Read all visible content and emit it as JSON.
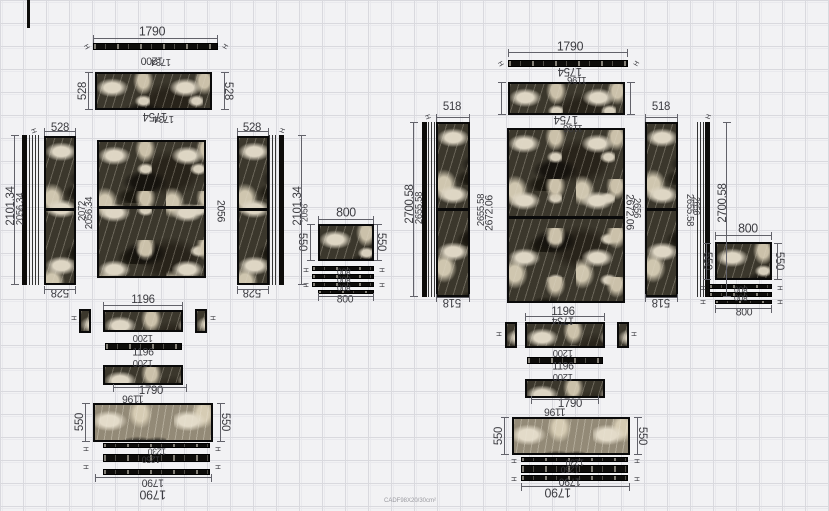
{
  "meta": {
    "watermark": "CADF98X20/30cm²"
  },
  "colors": {
    "canvas_bg": "#f2f2f4",
    "grid_line": "#d9d9de",
    "panel_frame": "#0a0a0a",
    "stone_dark": "#3b372c",
    "stone_vein": "#ded6c4",
    "dim_text": "#3c3c41",
    "dim_line": "#62626a"
  },
  "panels": [
    {
      "n": "corner-line",
      "k": "vs",
      "x": 27,
      "y": 0,
      "w": 3,
      "h": 28
    },
    {
      "n": "left-top-strip",
      "k": "hs",
      "x": 93,
      "y": 43,
      "w": 125,
      "h": 7
    },
    {
      "n": "left-top-panel",
      "k": "m",
      "x": 95,
      "y": 72,
      "w": 117,
      "h": 38
    },
    {
      "n": "left-edge-bar-left",
      "k": "vs",
      "x": 22,
      "y": 135,
      "w": 5,
      "h": 150
    },
    {
      "n": "left-edge-lines-left",
      "k": "ve",
      "x": 29,
      "y": 135,
      "w": 11,
      "h": 150
    },
    {
      "n": "left-side-panel-left",
      "k": "ms",
      "sp": 48,
      "x": 44,
      "y": 136,
      "w": 32,
      "h": 149
    },
    {
      "n": "left-center-panel",
      "k": "ms",
      "sp": 48,
      "x": 97,
      "y": 140,
      "w": 109,
      "h": 138
    },
    {
      "n": "left-side-panel-right",
      "k": "ms",
      "sp": 48,
      "x": 237,
      "y": 136,
      "w": 32,
      "h": 149
    },
    {
      "n": "left-edge-lines-right",
      "k": "ve",
      "x": 269,
      "y": 135,
      "w": 9,
      "h": 150
    },
    {
      "n": "left-edge-bar-right",
      "k": "vs",
      "x": 279,
      "y": 135,
      "w": 5,
      "h": 150
    },
    {
      "n": "left-800-panel",
      "k": "m",
      "x": 318,
      "y": 224,
      "w": 56,
      "h": 37
    },
    {
      "n": "left-800-strip-1",
      "k": "hs",
      "x": 312,
      "y": 266,
      "w": 62,
      "h": 5
    },
    {
      "n": "left-800-strip-2",
      "k": "hs",
      "x": 312,
      "y": 274,
      "w": 62,
      "h": 5
    },
    {
      "n": "left-800-strip-3",
      "k": "hs",
      "x": 312,
      "y": 282,
      "w": 62,
      "h": 5
    },
    {
      "n": "left-800-strip-4",
      "k": "hs",
      "x": 318,
      "y": 290,
      "w": 56,
      "h": 4
    },
    {
      "n": "left-bottom-square-left",
      "k": "sq",
      "x": 79,
      "y": 309,
      "w": 12,
      "h": 24
    },
    {
      "n": "left-bottom-row-1",
      "k": "m",
      "x": 103,
      "y": 310,
      "w": 80,
      "h": 22
    },
    {
      "n": "left-bottom-square-right",
      "k": "sq",
      "x": 195,
      "y": 309,
      "w": 12,
      "h": 24
    },
    {
      "n": "left-bottom-thin-strip",
      "k": "hs",
      "x": 105,
      "y": 343,
      "w": 77,
      "h": 7
    },
    {
      "n": "left-bottom-row-2",
      "k": "m",
      "x": 103,
      "y": 365,
      "w": 80,
      "h": 20
    },
    {
      "n": "left-bottom-panel",
      "k": "m2",
      "x": 93,
      "y": 403,
      "w": 120,
      "h": 39
    },
    {
      "n": "left-bottom-strip-1",
      "k": "hs",
      "x": 103,
      "y": 443,
      "w": 107,
      "h": 5
    },
    {
      "n": "left-bottom-strip-2",
      "k": "hs",
      "x": 103,
      "y": 454,
      "w": 107,
      "h": 8
    },
    {
      "n": "left-bottom-strip-3",
      "k": "hs",
      "x": 103,
      "y": 469,
      "w": 107,
      "h": 6
    },
    {
      "n": "right-top-strip",
      "k": "hs",
      "x": 508,
      "y": 60,
      "w": 120,
      "h": 7
    },
    {
      "n": "right-top-panel",
      "k": "m",
      "x": 508,
      "y": 82,
      "w": 117,
      "h": 33
    },
    {
      "n": "right-edge-bar-left",
      "k": "vs",
      "x": 422,
      "y": 122,
      "w": 5,
      "h": 175
    },
    {
      "n": "right-edge-lines-left",
      "k": "ve",
      "x": 428,
      "y": 122,
      "w": 7,
      "h": 175
    },
    {
      "n": "right-side-panel-left",
      "k": "ms",
      "sp": 49,
      "x": 436,
      "y": 122,
      "w": 34,
      "h": 175
    },
    {
      "n": "right-center-panel",
      "k": "ms",
      "sp": 50,
      "x": 507,
      "y": 128,
      "w": 118,
      "h": 175
    },
    {
      "n": "right-side-panel-right",
      "k": "ms",
      "sp": 49,
      "x": 645,
      "y": 122,
      "w": 33,
      "h": 175
    },
    {
      "n": "right-edge-lines-right",
      "k": "ve",
      "x": 697,
      "y": 122,
      "w": 7,
      "h": 175
    },
    {
      "n": "right-edge-bar-right",
      "k": "vs",
      "x": 705,
      "y": 122,
      "w": 5,
      "h": 175
    },
    {
      "n": "right-800-panel",
      "k": "m",
      "x": 715,
      "y": 242,
      "w": 57,
      "h": 38
    },
    {
      "n": "right-800-strip-1",
      "k": "hs",
      "x": 709,
      "y": 284,
      "w": 63,
      "h": 5
    },
    {
      "n": "right-800-strip-2",
      "k": "hs",
      "x": 709,
      "y": 292,
      "w": 63,
      "h": 5
    },
    {
      "n": "right-800-strip-3",
      "k": "hs",
      "x": 715,
      "y": 300,
      "w": 57,
      "h": 4
    },
    {
      "n": "right-bottom-square-left",
      "k": "sq",
      "x": 505,
      "y": 322,
      "w": 12,
      "h": 26
    },
    {
      "n": "right-bottom-row-1",
      "k": "m",
      "x": 525,
      "y": 322,
      "w": 80,
      "h": 26
    },
    {
      "n": "right-bottom-square-right",
      "k": "sq",
      "x": 617,
      "y": 322,
      "w": 12,
      "h": 26
    },
    {
      "n": "right-bottom-thin-strip",
      "k": "hs",
      "x": 527,
      "y": 357,
      "w": 76,
      "h": 7
    },
    {
      "n": "right-bottom-row-2",
      "k": "m",
      "x": 525,
      "y": 379,
      "w": 80,
      "h": 19
    },
    {
      "n": "right-bottom-panel",
      "k": "m2",
      "x": 512,
      "y": 417,
      "w": 118,
      "h": 38
    },
    {
      "n": "right-bottom-strip-1",
      "k": "hs",
      "x": 521,
      "y": 457,
      "w": 107,
      "h": 5
    },
    {
      "n": "right-bottom-strip-2",
      "k": "hs",
      "x": 521,
      "y": 465,
      "w": 107,
      "h": 8
    },
    {
      "n": "right-bottom-strip-3",
      "k": "hs",
      "x": 521,
      "y": 475,
      "w": 107,
      "h": 6
    }
  ],
  "labels": [
    {
      "t": "1790",
      "x": 152,
      "y": 31,
      "s": 13
    },
    {
      "t": "1200",
      "x": 152,
      "y": 60,
      "r": 180,
      "s": 11
    },
    {
      "t": "1734",
      "x": 161,
      "y": 61,
      "r": 180,
      "s": 10
    },
    {
      "t": "528",
      "x": 82,
      "y": 91,
      "r": -90,
      "s": 12
    },
    {
      "t": "528",
      "x": 229,
      "y": 91,
      "r": 90,
      "s": 12
    },
    {
      "t": "1754",
      "x": 155,
      "y": 117,
      "r": 180,
      "s": 12
    },
    {
      "t": "1734",
      "x": 164,
      "y": 118,
      "r": 180,
      "s": 10
    },
    {
      "t": "528",
      "x": 60,
      "y": 127,
      "s": 12
    },
    {
      "t": "528",
      "x": 252,
      "y": 127,
      "s": 12
    },
    {
      "t": "2101.34",
      "x": 10,
      "y": 206,
      "r": -90,
      "s": 12
    },
    {
      "t": "2056.34",
      "x": 21,
      "y": 209,
      "r": -90,
      "s": 10
    },
    {
      "t": "2072",
      "x": 83,
      "y": 211,
      "r": -90,
      "s": 10
    },
    {
      "t": "2056.34",
      "x": 90,
      "y": 213,
      "r": -90,
      "s": 10
    },
    {
      "t": "2056",
      "x": 220,
      "y": 211,
      "r": 90,
      "s": 11
    },
    {
      "t": "528",
      "x": 60,
      "y": 293,
      "r": 180,
      "s": 12
    },
    {
      "t": "528",
      "x": 252,
      "y": 293,
      "r": 180,
      "s": 12
    },
    {
      "t": "2101.34",
      "x": 297,
      "y": 206,
      "r": -90,
      "s": 12
    },
    {
      "t": "2056",
      "x": 305,
      "y": 213,
      "r": -90,
      "s": 9
    },
    {
      "t": "550",
      "x": 303,
      "y": 242,
      "r": 90,
      "s": 12
    },
    {
      "t": "800",
      "x": 346,
      "y": 212,
      "s": 13
    },
    {
      "t": "550",
      "x": 382,
      "y": 242,
      "r": 90,
      "s": 12
    },
    {
      "t": "800",
      "x": 344,
      "y": 271,
      "r": 180,
      "s": 9
    },
    {
      "t": "800",
      "x": 344,
      "y": 279,
      "r": 180,
      "s": 9
    },
    {
      "t": "800",
      "x": 344,
      "y": 287,
      "r": 180,
      "s": 9
    },
    {
      "t": "800",
      "x": 345,
      "y": 300,
      "s": 11
    },
    {
      "t": "1196",
      "x": 143,
      "y": 299,
      "s": 12
    },
    {
      "t": "1200",
      "x": 143,
      "y": 337,
      "r": 180,
      "s": 10
    },
    {
      "t": "1196",
      "x": 143,
      "y": 353,
      "s": 11
    },
    {
      "t": "1200",
      "x": 143,
      "y": 362,
      "r": 180,
      "s": 10
    },
    {
      "t": "1790",
      "x": 151,
      "y": 390,
      "s": 12
    },
    {
      "t": "1196",
      "x": 133,
      "y": 398,
      "r": 180,
      "s": 11
    },
    {
      "t": "550",
      "x": 79,
      "y": 422,
      "r": -90,
      "s": 12
    },
    {
      "t": "550",
      "x": 226,
      "y": 422,
      "r": 90,
      "s": 12
    },
    {
      "t": "1230",
      "x": 157,
      "y": 451,
      "r": 180,
      "s": 9
    },
    {
      "t": "1250",
      "x": 151,
      "y": 459,
      "r": 180,
      "s": 9
    },
    {
      "t": "1790",
      "x": 153,
      "y": 482,
      "r": 180,
      "s": 11
    },
    {
      "t": "1790",
      "x": 153,
      "y": 495,
      "r": 180,
      "s": 13
    },
    {
      "t": "1790",
      "x": 570,
      "y": 46,
      "s": 13
    },
    {
      "t": "1754",
      "x": 570,
      "y": 72,
      "r": 180,
      "s": 12
    },
    {
      "t": "1196",
      "x": 577,
      "y": 79,
      "r": 180,
      "s": 10
    },
    {
      "t": "1754",
      "x": 566,
      "y": 120,
      "r": 180,
      "s": 12
    },
    {
      "t": "1196",
      "x": 573,
      "y": 127,
      "r": 180,
      "s": 10
    },
    {
      "t": "518",
      "x": 452,
      "y": 106,
      "s": 12
    },
    {
      "t": "518",
      "x": 661,
      "y": 106,
      "s": 12
    },
    {
      "t": "2700.58",
      "x": 409,
      "y": 204,
      "r": -90,
      "s": 12
    },
    {
      "t": "2655.58",
      "x": 420,
      "y": 208,
      "r": -90,
      "s": 10
    },
    {
      "t": "2655.58",
      "x": 482,
      "y": 210,
      "r": -90,
      "s": 10
    },
    {
      "t": "2672.06",
      "x": 490,
      "y": 213,
      "r": -90,
      "s": 11
    },
    {
      "t": "2672.06",
      "x": 629,
      "y": 212,
      "r": 90,
      "s": 11
    },
    {
      "t": "2656",
      "x": 636,
      "y": 208,
      "r": 90,
      "s": 10
    },
    {
      "t": "2655.58",
      "x": 689,
      "y": 210,
      "r": 90,
      "s": 10
    },
    {
      "t": "2656",
      "x": 696,
      "y": 206,
      "r": 90,
      "s": 9
    },
    {
      "t": "2700.58",
      "x": 722,
      "y": 203,
      "r": -90,
      "s": 12
    },
    {
      "t": "518",
      "x": 452,
      "y": 303,
      "r": 180,
      "s": 12
    },
    {
      "t": "518",
      "x": 661,
      "y": 303,
      "r": 180,
      "s": 12
    },
    {
      "t": "800",
      "x": 748,
      "y": 228,
      "s": 13
    },
    {
      "t": "550",
      "x": 708,
      "y": 261,
      "r": 90,
      "s": 12
    },
    {
      "t": "550",
      "x": 780,
      "y": 261,
      "r": 90,
      "s": 12
    },
    {
      "t": "800",
      "x": 741,
      "y": 289,
      "r": 180,
      "s": 9
    },
    {
      "t": "800",
      "x": 741,
      "y": 297,
      "r": 180,
      "s": 9
    },
    {
      "t": "800",
      "x": 744,
      "y": 313,
      "s": 11
    },
    {
      "t": "1196",
      "x": 563,
      "y": 311,
      "s": 12
    },
    {
      "t": "1734",
      "x": 563,
      "y": 320,
      "r": 180,
      "s": 11
    },
    {
      "t": "1200",
      "x": 563,
      "y": 352,
      "r": 180,
      "s": 10
    },
    {
      "t": "1196",
      "x": 563,
      "y": 367,
      "s": 11
    },
    {
      "t": "1200",
      "x": 563,
      "y": 376,
      "r": 180,
      "s": 10
    },
    {
      "t": "1790",
      "x": 570,
      "y": 403,
      "s": 12
    },
    {
      "t": "1196",
      "x": 555,
      "y": 411,
      "r": 180,
      "s": 11
    },
    {
      "t": "550",
      "x": 498,
      "y": 436,
      "r": -90,
      "s": 12
    },
    {
      "t": "550",
      "x": 643,
      "y": 436,
      "r": 90,
      "s": 12
    },
    {
      "t": "1230",
      "x": 575,
      "y": 462,
      "r": 180,
      "s": 9
    },
    {
      "t": "1250",
      "x": 570,
      "y": 469,
      "r": 180,
      "s": 9
    },
    {
      "t": "1790",
      "x": 570,
      "y": 481,
      "r": 180,
      "s": 11
    },
    {
      "t": "1790",
      "x": 558,
      "y": 493,
      "r": 180,
      "s": 13
    },
    {
      "t": "H",
      "x": 86,
      "y": 47,
      "r": 60,
      "s": 7
    },
    {
      "t": "H",
      "x": 226,
      "y": 47,
      "r": -60,
      "s": 7
    },
    {
      "t": "H",
      "x": 500,
      "y": 64,
      "r": 60,
      "s": 7
    },
    {
      "t": "H",
      "x": 637,
      "y": 64,
      "r": -60,
      "s": 7
    },
    {
      "t": "H",
      "x": 33,
      "y": 131,
      "r": 70,
      "s": 7
    },
    {
      "t": "H",
      "x": 283,
      "y": 131,
      "r": -70,
      "s": 7
    },
    {
      "t": "H",
      "x": 427,
      "y": 117,
      "r": 70,
      "s": 7
    },
    {
      "t": "H",
      "x": 709,
      "y": 117,
      "r": -70,
      "s": 7
    },
    {
      "t": "H",
      "x": 305,
      "y": 270,
      "r": 90,
      "s": 7
    },
    {
      "t": "H",
      "x": 381,
      "y": 270,
      "r": 90,
      "s": 7
    },
    {
      "t": "H",
      "x": 305,
      "y": 285,
      "r": 90,
      "s": 7
    },
    {
      "t": "H",
      "x": 381,
      "y": 285,
      "r": 90,
      "s": 7
    },
    {
      "t": "H",
      "x": 702,
      "y": 288,
      "r": 90,
      "s": 7
    },
    {
      "t": "H",
      "x": 779,
      "y": 288,
      "r": 90,
      "s": 7
    },
    {
      "t": "H",
      "x": 702,
      "y": 302,
      "r": 90,
      "s": 7
    },
    {
      "t": "H",
      "x": 779,
      "y": 302,
      "r": 90,
      "s": 7
    },
    {
      "t": "H",
      "x": 85,
      "y": 449,
      "r": 90,
      "s": 7
    },
    {
      "t": "H",
      "x": 217,
      "y": 449,
      "r": 90,
      "s": 7
    },
    {
      "t": "H",
      "x": 85,
      "y": 467,
      "r": 90,
      "s": 7
    },
    {
      "t": "H",
      "x": 217,
      "y": 467,
      "r": 90,
      "s": 7
    },
    {
      "t": "H",
      "x": 513,
      "y": 461,
      "r": 90,
      "s": 7
    },
    {
      "t": "H",
      "x": 636,
      "y": 461,
      "r": 90,
      "s": 7
    },
    {
      "t": "H",
      "x": 513,
      "y": 479,
      "r": 90,
      "s": 7
    },
    {
      "t": "H",
      "x": 636,
      "y": 479,
      "r": 90,
      "s": 7
    },
    {
      "t": "H",
      "x": 73,
      "y": 318,
      "r": 90,
      "s": 7
    },
    {
      "t": "H",
      "x": 212,
      "y": 318,
      "r": 90,
      "s": 7
    },
    {
      "t": "H",
      "x": 498,
      "y": 334,
      "r": 90,
      "s": 7
    },
    {
      "t": "H",
      "x": 633,
      "y": 334,
      "r": 90,
      "s": 7
    }
  ],
  "dimlines": [
    {
      "x": 93,
      "y": 38,
      "len": 125
    },
    {
      "x": 88,
      "y": 72,
      "len": 38,
      "v": 1
    },
    {
      "x": 224,
      "y": 72,
      "len": 38,
      "v": 1
    },
    {
      "x": 44,
      "y": 131,
      "len": 32
    },
    {
      "x": 44,
      "y": 289,
      "len": 32
    },
    {
      "x": 237,
      "y": 131,
      "len": 32
    },
    {
      "x": 237,
      "y": 289,
      "len": 32
    },
    {
      "x": 14,
      "y": 135,
      "len": 150,
      "v": 1
    },
    {
      "x": 301,
      "y": 135,
      "len": 150,
      "v": 1
    },
    {
      "x": 318,
      "y": 219,
      "len": 56
    },
    {
      "x": 318,
      "y": 296,
      "len": 56
    },
    {
      "x": 310,
      "y": 224,
      "len": 37,
      "v": 1
    },
    {
      "x": 377,
      "y": 224,
      "len": 37,
      "v": 1
    },
    {
      "x": 103,
      "y": 305,
      "len": 80
    },
    {
      "x": 113,
      "y": 387,
      "len": 74
    },
    {
      "x": 85,
      "y": 403,
      "len": 39,
      "v": 1
    },
    {
      "x": 220,
      "y": 403,
      "len": 39,
      "v": 1
    },
    {
      "x": 95,
      "y": 477,
      "len": 117
    },
    {
      "x": 508,
      "y": 52,
      "len": 120
    },
    {
      "x": 501,
      "y": 82,
      "len": 33,
      "v": 1
    },
    {
      "x": 630,
      "y": 82,
      "len": 33,
      "v": 1
    },
    {
      "x": 436,
      "y": 117,
      "len": 34
    },
    {
      "x": 436,
      "y": 297,
      "len": 34
    },
    {
      "x": 645,
      "y": 117,
      "len": 33
    },
    {
      "x": 645,
      "y": 297,
      "len": 33
    },
    {
      "x": 413,
      "y": 122,
      "len": 175,
      "v": 1
    },
    {
      "x": 726,
      "y": 122,
      "len": 175,
      "v": 1
    },
    {
      "x": 715,
      "y": 235,
      "len": 57
    },
    {
      "x": 715,
      "y": 308,
      "len": 57
    },
    {
      "x": 706,
      "y": 243,
      "len": 37,
      "v": 1
    },
    {
      "x": 777,
      "y": 243,
      "len": 37,
      "v": 1
    },
    {
      "x": 525,
      "y": 316,
      "len": 80
    },
    {
      "x": 531,
      "y": 399,
      "len": 68
    },
    {
      "x": 504,
      "y": 417,
      "len": 38,
      "v": 1
    },
    {
      "x": 637,
      "y": 417,
      "len": 38,
      "v": 1
    },
    {
      "x": 521,
      "y": 486,
      "len": 109
    }
  ]
}
